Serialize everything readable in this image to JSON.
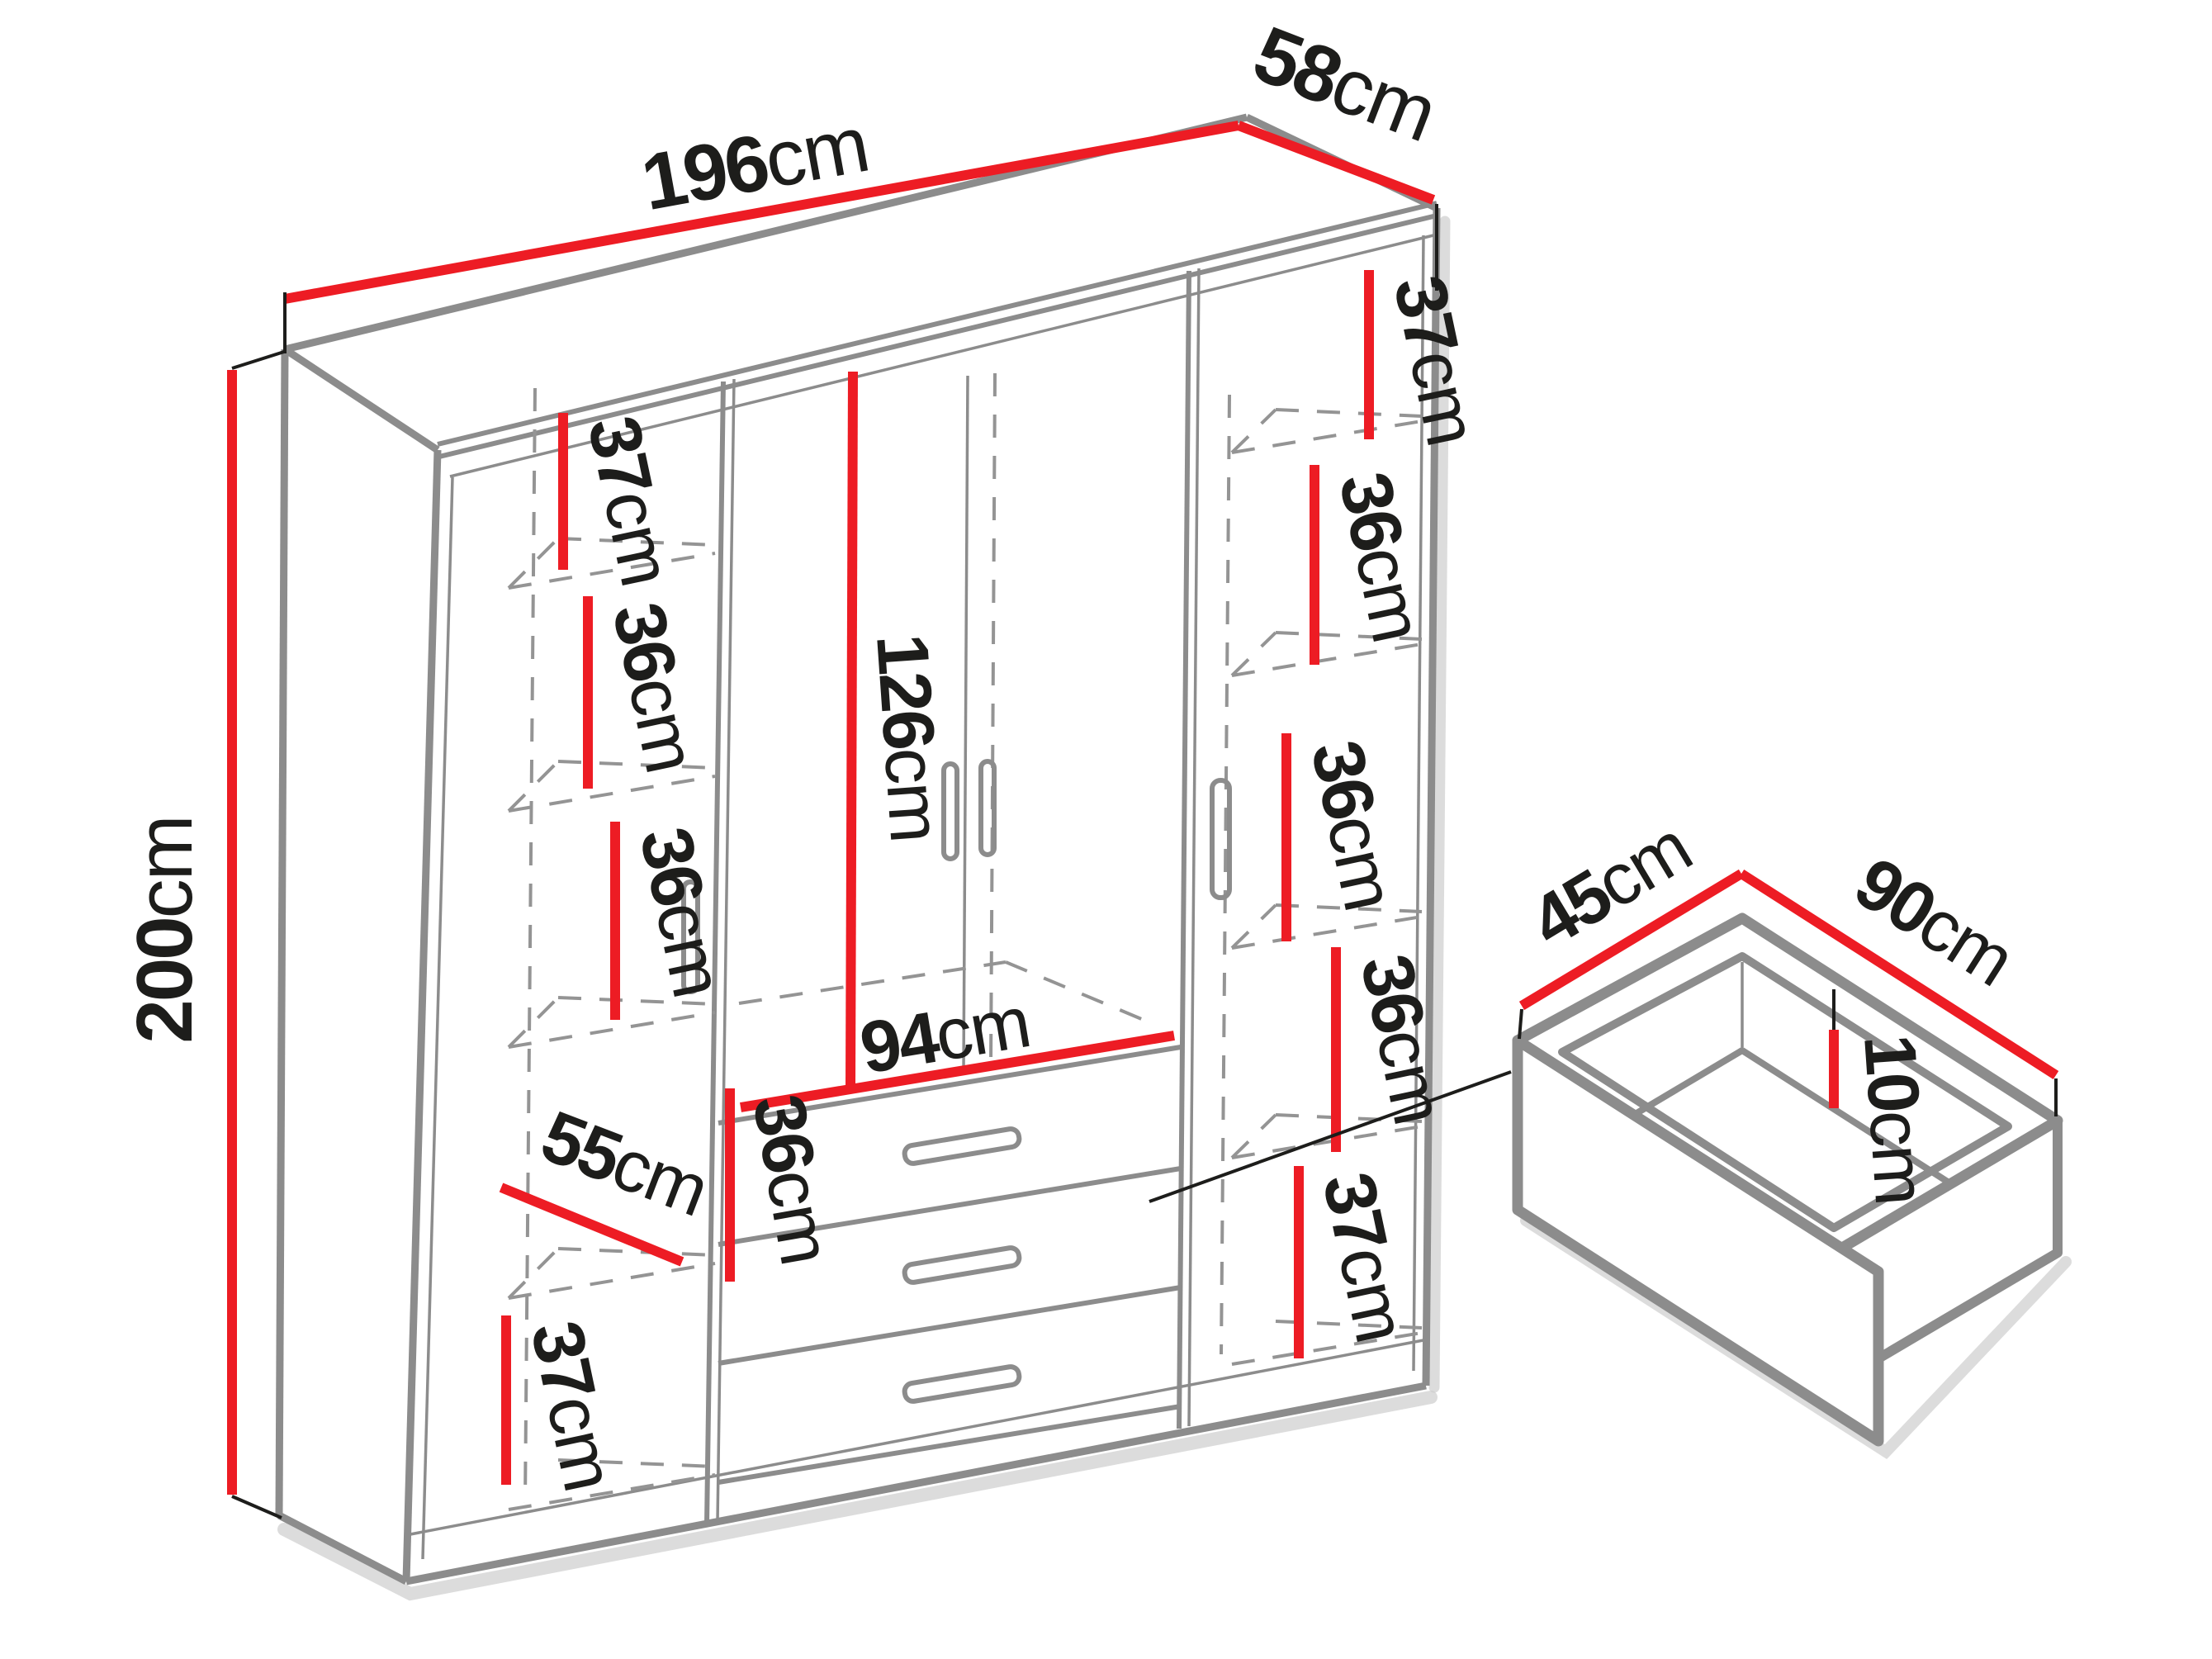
{
  "wardrobe": {
    "width_label": {
      "value": "196",
      "unit": "cm"
    },
    "depth_label": {
      "value": "58",
      "unit": "cm"
    },
    "height_label": {
      "value": "200",
      "unit": "cm"
    },
    "left_column": {
      "shelves": [
        {
          "value": "37",
          "unit": "cm"
        },
        {
          "value": "36",
          "unit": "cm"
        },
        {
          "value": "36",
          "unit": "cm"
        },
        {
          "value": "36",
          "unit": "cm"
        },
        {
          "value": "37",
          "unit": "cm"
        }
      ],
      "bottom_depth": {
        "value": "55",
        "unit": "cm"
      }
    },
    "middle": {
      "door_height": {
        "value": "126",
        "unit": "cm"
      },
      "drawer_width": {
        "value": "94",
        "unit": "cm"
      },
      "shelf": {
        "value": "36",
        "unit": "cm"
      }
    },
    "right_column": {
      "shelves": [
        {
          "value": "37",
          "unit": "cm"
        },
        {
          "value": "36",
          "unit": "cm"
        },
        {
          "value": "36",
          "unit": "cm"
        },
        {
          "value": "36",
          "unit": "cm"
        },
        {
          "value": "37",
          "unit": "cm"
        }
      ]
    }
  },
  "drawer_detail": {
    "depth": {
      "value": "45",
      "unit": "cm"
    },
    "width": {
      "value": "90",
      "unit": "cm"
    },
    "height": {
      "value": "10",
      "unit": "cm"
    }
  },
  "colors": {
    "dimension_red": "#ed1c24",
    "edge_gray": "#8c8c8c",
    "text_black": "#1d1d1b",
    "shadow_gray": "#c9c9c9"
  }
}
